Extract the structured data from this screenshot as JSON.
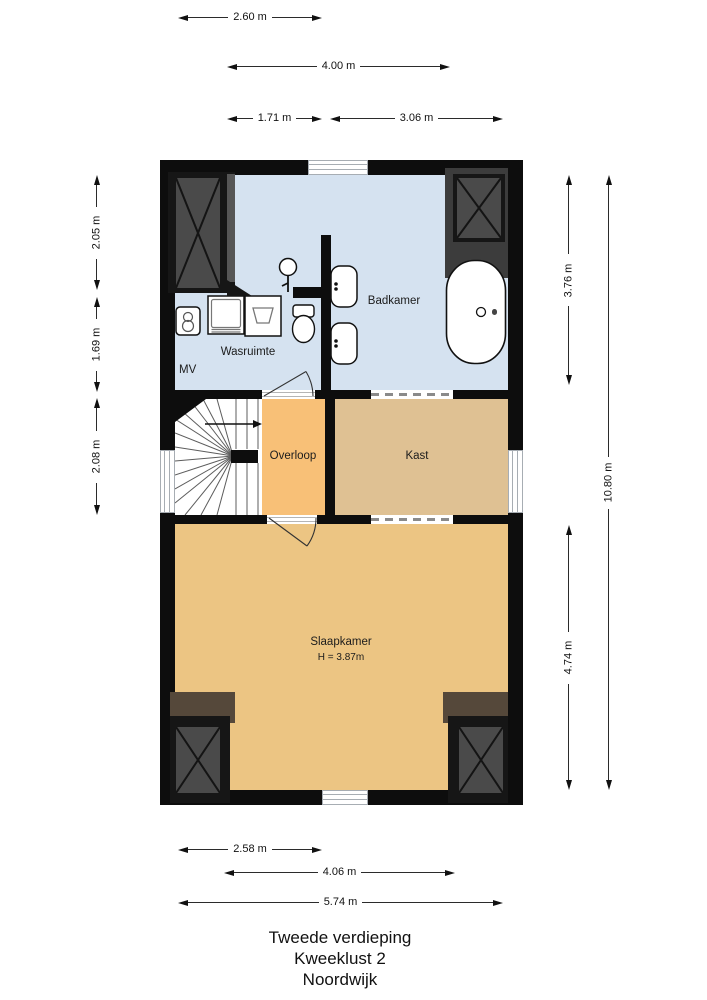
{
  "title": {
    "line1": "Tweede verdieping",
    "line2": "Kweeklust 2",
    "line3": "Noordwijk"
  },
  "rooms": {
    "badkamer": {
      "label": "Badkamer"
    },
    "wasruimte": {
      "label": "Wasruimte"
    },
    "mv": {
      "label": "MV"
    },
    "overloop": {
      "label": "Overloop"
    },
    "kast": {
      "label": "Kast"
    },
    "slaapkamer": {
      "label": "Slaapkamer",
      "height_note": "H = 3.87m"
    }
  },
  "dimensions": {
    "top": [
      {
        "label": "2.60 m"
      },
      {
        "label": "4.00 m"
      },
      {
        "label": "1.71 m"
      },
      {
        "label": "3.06 m"
      }
    ],
    "left": [
      {
        "label": "2.05 m"
      },
      {
        "label": "1.69 m"
      },
      {
        "label": "2.08 m"
      }
    ],
    "right": [
      {
        "label": "3.76 m"
      },
      {
        "label": "10.80 m"
      },
      {
        "label": "4.74 m"
      }
    ],
    "bottom": [
      {
        "label": "2.58 m"
      },
      {
        "label": "4.06 m"
      },
      {
        "label": "5.74 m"
      }
    ]
  },
  "colors": {
    "badkamer_fill": "#d5e2f0",
    "overloop_fill": "#f8c077",
    "kast_fill": "#dfc193",
    "slaapkamer_fill": "#ecc583",
    "wall": "#0d0d0d",
    "wardrobe_dark": "#3c3c3c",
    "wardrobe_inner": "#4a4a4a",
    "wardrobe_brown": "#55483a"
  }
}
